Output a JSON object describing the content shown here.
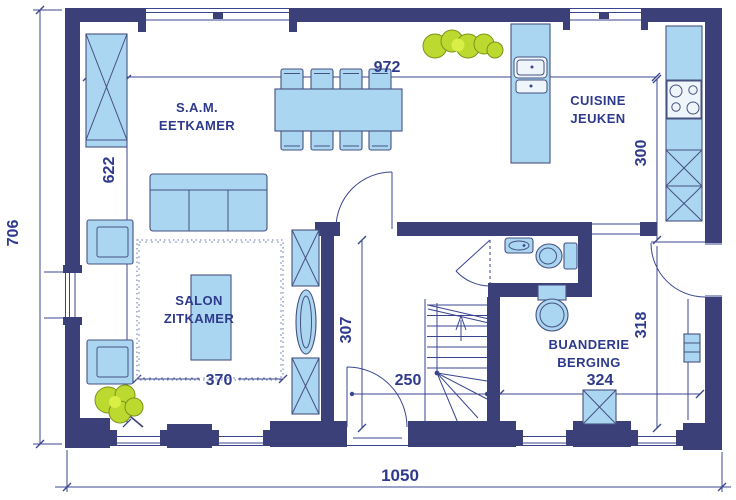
{
  "plan": {
    "title": "ground-floor-plan",
    "rooms": [
      {
        "name": "dining-room",
        "line1": "S.A.M.",
        "line2": "EETKAMER"
      },
      {
        "name": "kitchen",
        "line1": "CUISINE",
        "line2": "JEUKEN"
      },
      {
        "name": "living-room",
        "line1": "SALON",
        "line2": "ZITKAMER"
      },
      {
        "name": "laundry-storage",
        "line1": "BUANDERIE",
        "line2": "BERGING"
      }
    ],
    "dimensions": {
      "total_width": "1050",
      "total_depth": "706",
      "interior_width": "972",
      "dining_depth": "622",
      "kitchen_depth": "300",
      "hall_depth": "307",
      "stair_width": "250",
      "living_width": "370",
      "laundry_depth": "318",
      "laundry_width": "324"
    },
    "furniture_symbols": [
      "dining-table",
      "dining-chair",
      "sofa",
      "armchair",
      "coffee-table",
      "rug",
      "storage-cabinet",
      "sideboard",
      "kitchen-island-sink",
      "cooktop",
      "tall-kitchen-unit",
      "washbasin",
      "toilet",
      "washing-machine",
      "stairs",
      "plant",
      "radiator",
      "door-swing",
      "window"
    ],
    "colors": {
      "wall": "#3c4078",
      "thin_line": "#3a4590",
      "label_text": "#2e3a8c",
      "furniture_fill": "#abd6f1",
      "furniture_stroke": "#465180",
      "plant_fill": "#bcd92f",
      "rug_stroke": "#8191bd"
    }
  }
}
